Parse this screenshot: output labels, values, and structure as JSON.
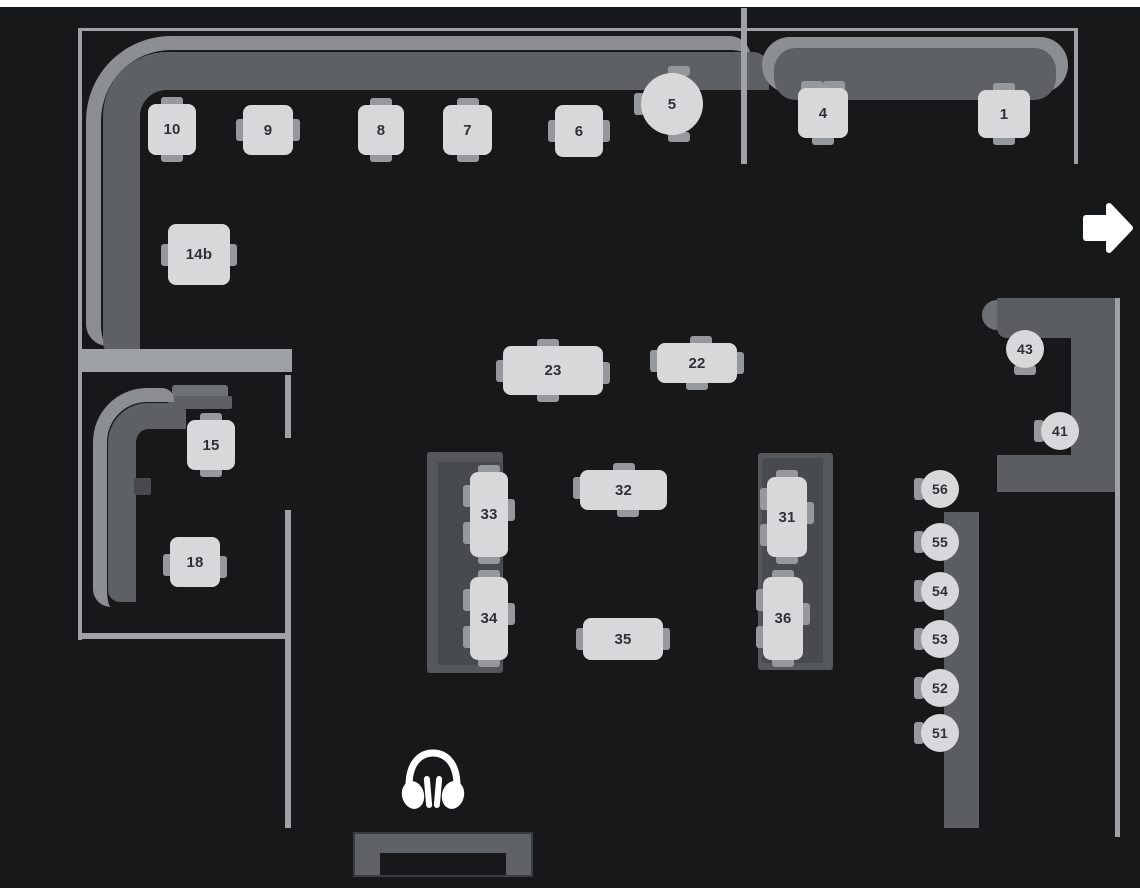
{
  "colors": {
    "background": "#16181a",
    "top_strip": "#ffffff",
    "wall": "#9fa2a5",
    "bench_back": "#8c8f92",
    "bench_seat": "#5e6164",
    "booth_outer": "#55585b",
    "booth_inner": "#484b4e",
    "counter": "#5b5e61",
    "counter_back": "#6e7174",
    "table_fill": "#d6d8d9",
    "table_text": "#2e3236",
    "chair": "#96999b",
    "side_table": "#47494c",
    "dj_booth": "#5f6265",
    "icon": "#ffffff"
  },
  "icons": {
    "exit": "arrow-right-icon",
    "dj": "headphones-icon"
  },
  "tables": [
    {
      "id": "t10",
      "label": "10",
      "shape": "square",
      "x": 148,
      "y": 104,
      "w": 48,
      "h": 51,
      "chairs": [
        {
          "side": "top",
          "pos": 0.5
        },
        {
          "side": "bottom",
          "pos": 0.5
        }
      ]
    },
    {
      "id": "t9",
      "label": "9",
      "shape": "square",
      "x": 243,
      "y": 105,
      "w": 50,
      "h": 50,
      "chairs": [
        {
          "side": "left",
          "pos": 0.5
        },
        {
          "side": "right",
          "pos": 0.5
        }
      ]
    },
    {
      "id": "t8",
      "label": "8",
      "shape": "square",
      "x": 358,
      "y": 105,
      "w": 46,
      "h": 50,
      "chairs": [
        {
          "side": "top",
          "pos": 0.5
        },
        {
          "side": "bottom",
          "pos": 0.5
        }
      ]
    },
    {
      "id": "t7",
      "label": "7",
      "shape": "square",
      "x": 443,
      "y": 105,
      "w": 49,
      "h": 50,
      "chairs": [
        {
          "side": "top",
          "pos": 0.5
        },
        {
          "side": "bottom",
          "pos": 0.5
        }
      ]
    },
    {
      "id": "t6",
      "label": "6",
      "shape": "square",
      "x": 555,
      "y": 105,
      "w": 48,
      "h": 52,
      "chairs": [
        {
          "side": "left",
          "pos": 0.5
        },
        {
          "side": "right",
          "pos": 0.5
        }
      ]
    },
    {
      "id": "t5",
      "label": "5",
      "shape": "round",
      "x": 641,
      "y": 73,
      "w": 62,
      "h": 62,
      "chairs": [
        {
          "side": "left",
          "pos": 0.5
        },
        {
          "side": "top",
          "pos": 0.62
        },
        {
          "side": "bottom",
          "pos": 0.62
        }
      ]
    },
    {
      "id": "t14b",
      "label": "14b",
      "shape": "square",
      "x": 168,
      "y": 224,
      "w": 62,
      "h": 61,
      "chairs": [
        {
          "side": "left",
          "pos": 0.5
        },
        {
          "side": "right",
          "pos": 0.5
        }
      ]
    },
    {
      "id": "t4",
      "label": "4",
      "shape": "square",
      "x": 798,
      "y": 88,
      "w": 50,
      "h": 50,
      "chairs": [
        {
          "side": "top",
          "pos": 0.28
        },
        {
          "side": "top",
          "pos": 0.72
        },
        {
          "side": "bottom",
          "pos": 0.5
        }
      ]
    },
    {
      "id": "t1",
      "label": "1",
      "shape": "square",
      "x": 978,
      "y": 90,
      "w": 52,
      "h": 48,
      "chairs": [
        {
          "side": "top",
          "pos": 0.5
        },
        {
          "side": "bottom",
          "pos": 0.5
        }
      ]
    },
    {
      "id": "t23",
      "label": "23",
      "shape": "rect",
      "x": 503,
      "y": 346,
      "w": 100,
      "h": 49,
      "chairs": [
        {
          "side": "top",
          "pos": 0.45
        },
        {
          "side": "bottom",
          "pos": 0.45
        },
        {
          "side": "left",
          "pos": 0.5
        },
        {
          "side": "right",
          "pos": 0.55
        }
      ]
    },
    {
      "id": "t22",
      "label": "22",
      "shape": "rect",
      "x": 657,
      "y": 343,
      "w": 80,
      "h": 40,
      "chairs": [
        {
          "side": "top",
          "pos": 0.55
        },
        {
          "side": "bottom",
          "pos": 0.5
        },
        {
          "side": "left",
          "pos": 0.45
        },
        {
          "side": "right",
          "pos": 0.5
        }
      ]
    },
    {
      "id": "t15",
      "label": "15",
      "shape": "square",
      "x": 187,
      "y": 420,
      "w": 48,
      "h": 50,
      "chairs": [
        {
          "side": "top",
          "pos": 0.5
        },
        {
          "side": "bottom",
          "pos": 0.5
        }
      ]
    },
    {
      "id": "t18",
      "label": "18",
      "shape": "square",
      "x": 170,
      "y": 537,
      "w": 50,
      "h": 50,
      "chairs": [
        {
          "side": "left",
          "pos": 0.55
        },
        {
          "side": "right",
          "pos": 0.6
        }
      ]
    },
    {
      "id": "t32",
      "label": "32",
      "shape": "rect",
      "x": 580,
      "y": 470,
      "w": 87,
      "h": 40,
      "chairs": [
        {
          "side": "left",
          "pos": 0.45
        },
        {
          "side": "top",
          "pos": 0.5
        },
        {
          "side": "bottom",
          "pos": 0.55
        }
      ]
    },
    {
      "id": "t33",
      "label": "33",
      "shape": "vrect",
      "x": 470,
      "y": 472,
      "w": 38,
      "h": 85,
      "chairs": [
        {
          "side": "left",
          "pos": 0.28
        },
        {
          "side": "left",
          "pos": 0.72
        },
        {
          "side": "right",
          "pos": 0.45
        },
        {
          "side": "top",
          "pos": 0.5
        },
        {
          "side": "bottom",
          "pos": 0.5
        }
      ]
    },
    {
      "id": "t34",
      "label": "34",
      "shape": "vrect",
      "x": 470,
      "y": 577,
      "w": 38,
      "h": 83,
      "chairs": [
        {
          "side": "left",
          "pos": 0.28
        },
        {
          "side": "left",
          "pos": 0.72
        },
        {
          "side": "right",
          "pos": 0.45
        },
        {
          "side": "top",
          "pos": 0.5
        },
        {
          "side": "bottom",
          "pos": 0.5
        }
      ]
    },
    {
      "id": "t31",
      "label": "31",
      "shape": "vrect",
      "x": 767,
      "y": 477,
      "w": 40,
      "h": 80,
      "chairs": [
        {
          "side": "left",
          "pos": 0.28
        },
        {
          "side": "left",
          "pos": 0.72
        },
        {
          "side": "right",
          "pos": 0.45
        },
        {
          "side": "top",
          "pos": 0.5
        },
        {
          "side": "bottom",
          "pos": 0.5
        }
      ]
    },
    {
      "id": "t36",
      "label": "36",
      "shape": "vrect",
      "x": 763,
      "y": 577,
      "w": 40,
      "h": 83,
      "chairs": [
        {
          "side": "left",
          "pos": 0.28
        },
        {
          "side": "left",
          "pos": 0.72
        },
        {
          "side": "right",
          "pos": 0.45
        },
        {
          "side": "top",
          "pos": 0.5
        },
        {
          "side": "bottom",
          "pos": 0.5
        }
      ]
    },
    {
      "id": "t35",
      "label": "35",
      "shape": "rect",
      "x": 583,
      "y": 618,
      "w": 80,
      "h": 42,
      "chairs": [
        {
          "side": "left",
          "pos": 0.5
        },
        {
          "side": "right",
          "pos": 0.5
        }
      ]
    }
  ],
  "stools": [
    {
      "label": "43",
      "x": 1006,
      "y": 330,
      "chair": {
        "side": "bottom",
        "pos": 0.5
      }
    },
    {
      "label": "41",
      "x": 1041,
      "y": 412,
      "chair": {
        "side": "left",
        "pos": 0.5
      }
    },
    {
      "label": "56",
      "x": 921,
      "y": 470,
      "chair": {
        "side": "left",
        "pos": 0.5
      }
    },
    {
      "label": "55",
      "x": 921,
      "y": 523,
      "chair": {
        "side": "left",
        "pos": 0.5
      }
    },
    {
      "label": "54",
      "x": 921,
      "y": 572,
      "chair": {
        "side": "left",
        "pos": 0.5
      }
    },
    {
      "label": "53",
      "x": 921,
      "y": 620,
      "chair": {
        "side": "left",
        "pos": 0.5
      }
    },
    {
      "label": "52",
      "x": 921,
      "y": 669,
      "chair": {
        "side": "left",
        "pos": 0.5
      }
    },
    {
      "label": "51",
      "x": 921,
      "y": 714,
      "chair": {
        "side": "left",
        "pos": 0.5
      }
    }
  ]
}
